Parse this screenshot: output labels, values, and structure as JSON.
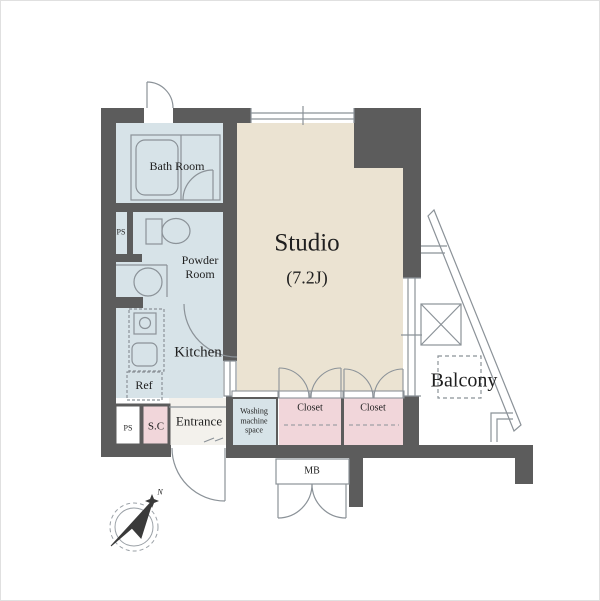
{
  "rooms": {
    "studio": {
      "label": "Studio",
      "size": "(7.2J)"
    },
    "bath": {
      "label": "Bath Room"
    },
    "powder": {
      "line1": "Powder",
      "line2": "Room"
    },
    "kitchen": {
      "label": "Kitchen"
    },
    "ref": {
      "label": "Ref"
    },
    "entrance": {
      "label": "Entrance"
    },
    "shoe_closet": {
      "label": "S.C"
    },
    "washing": {
      "line1": "Washing",
      "line2": "machine",
      "line3": "space"
    },
    "closet_left": {
      "label": "Closet"
    },
    "closet_right": {
      "label": "Closet"
    },
    "balcony": {
      "label": "Balcony"
    },
    "meter_box": {
      "label": "MB"
    },
    "pipe_space_upper": {
      "label": "PS"
    },
    "pipe_space_lower": {
      "label": "PS"
    }
  },
  "compass": {
    "north_label": "N"
  },
  "colors": {
    "wall": "#5c5c5c",
    "studio_floor": "#ebe3d2",
    "wet_area_floor": "#d7e3e8",
    "closet_pink": "#f1d6da",
    "entrance_floor": "#f3f1ec",
    "thin_line": "#8b9298",
    "text": "#1f1f1f"
  }
}
